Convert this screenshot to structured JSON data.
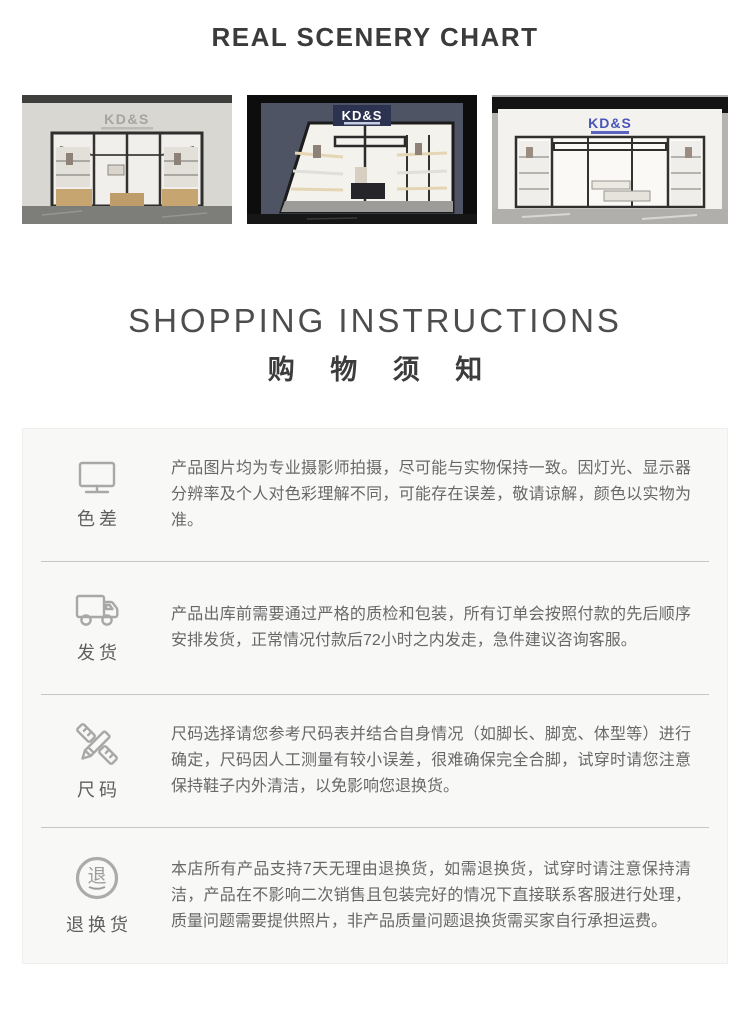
{
  "page": {
    "title": "REAL SCENERY CHART",
    "heading_en": "SHOPPING INSTRUCTIONS",
    "heading_cn": "购 物 须 知"
  },
  "photos": [
    {
      "name": "storefront-light-gray",
      "sign": "KD&S"
    },
    {
      "name": "storefront-dark-angled",
      "sign": "KD&S"
    },
    {
      "name": "storefront-white",
      "sign": "KD&S"
    }
  ],
  "instructions": [
    {
      "icon": "monitor-icon",
      "label": "色差",
      "text": "产品图片均为专业摄影师拍摄，尽可能与实物保持一致。因灯光、显示器分辨率及个人对色彩理解不同，可能存在误差，敬请谅解，颜色以实物为准。"
    },
    {
      "icon": "truck-icon",
      "label": "发货",
      "text": "产品出库前需要通过严格的质检和包装，所有订单会按照付款的先后顺序安排发货，正常情况付款后72小时之内发走，急件建议咨询客服。"
    },
    {
      "icon": "pencil-ruler-icon",
      "label": "尺码",
      "text": "尺码选择请您参考尺码表并结合自身情况（如脚长、脚宽、体型等）进行确定，尺码因人工测量有较小误差，很难确保完全合脚，试穿时请您注意保持鞋子内外清洁，以免影响您退换货。"
    },
    {
      "icon": "return-icon",
      "label": "退换货",
      "badge_char": "退",
      "text": "本店所有产品支持7天无理由退换货，如需退换货，试穿时请注意保持清洁，产品在不影响二次销售且包装完好的情况下直接联系客服进行处理，质量问题需要提供照片，非产品质量问题退换货需买家自行承担运费。"
    }
  ],
  "colors": {
    "title_text": "#3b3b3b",
    "body_text": "#686868",
    "icon_gray": "#a8a8a8",
    "box_bg": "#f8f8f7",
    "divider": "#c6c6c5",
    "sign_navy": "#2c3350",
    "sign_blue": "#4a55b8"
  }
}
